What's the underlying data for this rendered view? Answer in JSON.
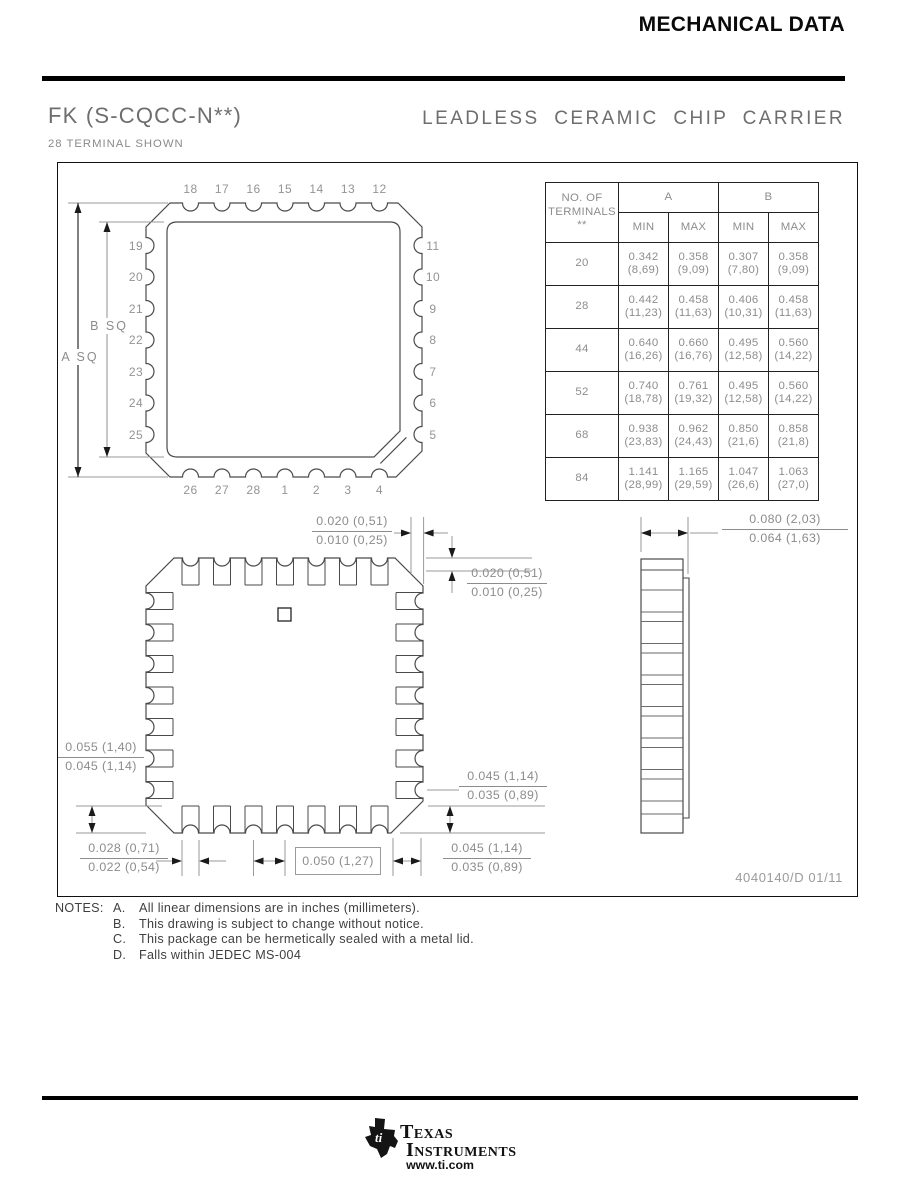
{
  "header": {
    "title": "MECHANICAL DATA"
  },
  "title_block": {
    "code": "FK (S-CQCC-N**)",
    "name": "LEADLESS CERAMIC CHIP CARRIER",
    "variant_note": "28 TERMINAL SHOWN"
  },
  "pins": {
    "top": [
      "18",
      "17",
      "16",
      "15",
      "14",
      "13",
      "12"
    ],
    "right": [
      "11",
      "10",
      "9",
      "8",
      "7",
      "6",
      "5"
    ],
    "bottom": [
      "26",
      "27",
      "28",
      "1",
      "2",
      "3",
      "4"
    ],
    "left": [
      "19",
      "20",
      "21",
      "22",
      "23",
      "24",
      "25"
    ]
  },
  "dimensions": {
    "a_sq": "A SQ",
    "b_sq": "B SQ",
    "top_lead": {
      "max": "0.020 (0,51)",
      "min": "0.010 (0,25)"
    },
    "right_lead": {
      "max": "0.020 (0,51)",
      "min": "0.010 (0,25)"
    },
    "left_corner": {
      "max": "0.055 (1,40)",
      "min": "0.045 (1,14)"
    },
    "lead_width": {
      "max": "0.028 (0,71)",
      "min": "0.022 (0,54)"
    },
    "pitch": "0.050 (1,27)",
    "bottom_corner": {
      "max": "0.045 (1,14)",
      "min": "0.035 (0,89)"
    },
    "right_corner": {
      "max": "0.045 (1,14)",
      "min": "0.035 (0,89)"
    },
    "thickness": {
      "max": "0.080 (2,03)",
      "min": "0.064 (1,63)"
    }
  },
  "table": {
    "terminals_header": [
      "NO. OF",
      "TERMINALS",
      "**"
    ],
    "groups": [
      "A",
      "B"
    ],
    "subheaders": [
      "MIN",
      "MAX",
      "MIN",
      "MAX"
    ],
    "rows": [
      {
        "terminals": "20",
        "cells": [
          {
            "in": "0.342",
            "mm": "(8,69)"
          },
          {
            "in": "0.358",
            "mm": "(9,09)"
          },
          {
            "in": "0.307",
            "mm": "(7,80)"
          },
          {
            "in": "0.358",
            "mm": "(9,09)"
          }
        ]
      },
      {
        "terminals": "28",
        "cells": [
          {
            "in": "0.442",
            "mm": "(11,23)"
          },
          {
            "in": "0.458",
            "mm": "(11,63)"
          },
          {
            "in": "0.406",
            "mm": "(10,31)"
          },
          {
            "in": "0.458",
            "mm": "(11,63)"
          }
        ]
      },
      {
        "terminals": "44",
        "cells": [
          {
            "in": "0.640",
            "mm": "(16,26)"
          },
          {
            "in": "0.660",
            "mm": "(16,76)"
          },
          {
            "in": "0.495",
            "mm": "(12,58)"
          },
          {
            "in": "0.560",
            "mm": "(14,22)"
          }
        ]
      },
      {
        "terminals": "52",
        "cells": [
          {
            "in": "0.740",
            "mm": "(18,78)"
          },
          {
            "in": "0.761",
            "mm": "(19,32)"
          },
          {
            "in": "0.495",
            "mm": "(12,58)"
          },
          {
            "in": "0.560",
            "mm": "(14,22)"
          }
        ]
      },
      {
        "terminals": "68",
        "cells": [
          {
            "in": "0.938",
            "mm": "(23,83)"
          },
          {
            "in": "0.962",
            "mm": "(24,43)"
          },
          {
            "in": "0.850",
            "mm": "(21,6)"
          },
          {
            "in": "0.858",
            "mm": "(21,8)"
          }
        ]
      },
      {
        "terminals": "84",
        "cells": [
          {
            "in": "1.141",
            "mm": "(28,99)"
          },
          {
            "in": "1.165",
            "mm": "(29,59)"
          },
          {
            "in": "1.047",
            "mm": "(26,6)"
          },
          {
            "in": "1.063",
            "mm": "(27,0)"
          }
        ]
      }
    ]
  },
  "drawing_number": "4040140/D 01/11",
  "notes": {
    "label": "NOTES:",
    "items": [
      {
        "letter": "A.",
        "text": "All linear dimensions are in inches (millimeters)."
      },
      {
        "letter": "B.",
        "text": "This drawing is subject to change without notice."
      },
      {
        "letter": "C.",
        "text": "This package can be hermetically sealed with a metal lid."
      },
      {
        "letter": "D.",
        "text": "Falls within JEDEC MS-004"
      }
    ]
  },
  "footer": {
    "brand_top": "Texas",
    "brand_bottom": "Instruments",
    "url": "www.ti.com"
  }
}
